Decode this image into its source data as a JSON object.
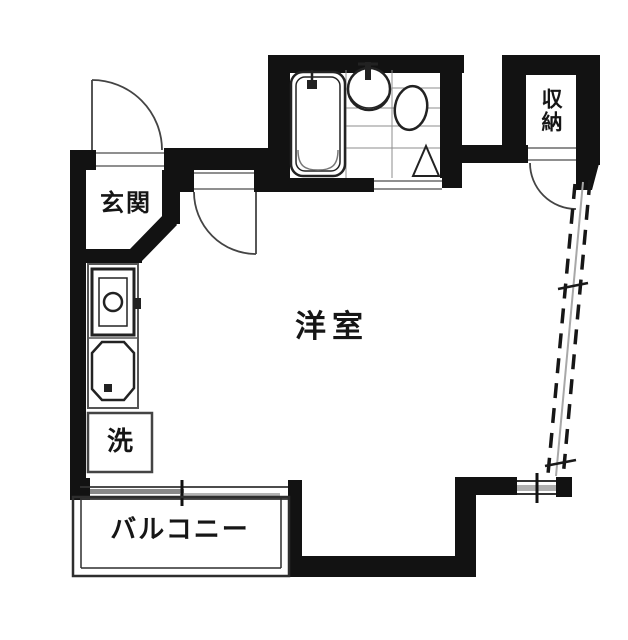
{
  "floorplan": {
    "type": "apartment-floor-plan",
    "rooms": {
      "entrance": {
        "label": "玄関"
      },
      "western_room": {
        "label": "洋室"
      },
      "storage": {
        "label": "収納"
      },
      "laundry": {
        "label": "洗"
      },
      "balcony": {
        "label": "バルコニー"
      }
    },
    "fixtures": [
      "bathtub",
      "wash-basin",
      "toilet",
      "bathroom-tile-floor",
      "bathroom-triangle",
      "stove-unit",
      "kitchen-sink",
      "entry-door",
      "room-door",
      "storage-door",
      "bathroom-sliding-door",
      "balcony-sliding-door",
      "diagonal-window-wall",
      "corner-window"
    ],
    "colors": {
      "wall": "#121212",
      "line": "#333333",
      "frame": "#6a6a6a",
      "grid": "#8c8c8c",
      "sash_dark": "#8a8a8a",
      "sash_light": "#b5b5b5",
      "background": "#ffffff",
      "text": "#161616"
    }
  }
}
